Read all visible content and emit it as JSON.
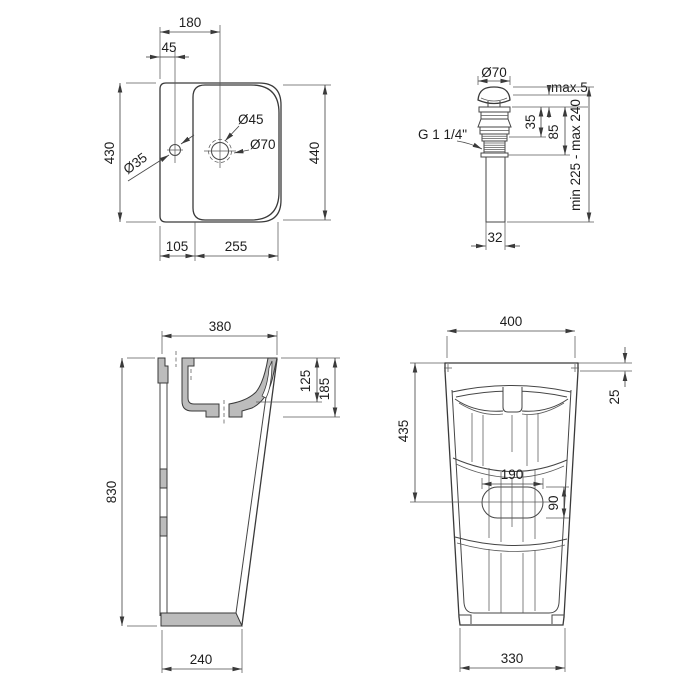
{
  "drawing": {
    "type": "technical-dimension-drawing",
    "subject": "freestanding washbasin with pop-up drain valve",
    "background_color": "#ffffff",
    "line_color": "#3a3a3a",
    "section_fill_color": "#bcbcbc",
    "views": {
      "top": {
        "name": "sink top view",
        "dims": {
          "drain_offset": "180",
          "faucet_offset": "45",
          "height_left": "430",
          "height_right": "440",
          "deck_width": "105",
          "bowl_width": "255",
          "drain_inner": "Ø45",
          "drain_outer": "Ø70",
          "faucet_hole": "Ø35"
        }
      },
      "valve": {
        "name": "pop-up drain valve",
        "dims": {
          "cap_diameter": "Ø70",
          "cap_gap": "max.5",
          "flange_depth": "35",
          "body_depth": "85",
          "thread": "G 1 1/4\"",
          "total_length": "min 225 - max 240",
          "pipe_diameter": "32"
        }
      },
      "side": {
        "name": "side section view",
        "dims": {
          "depth_top": "380",
          "bowl_inner_depth": "125",
          "bowl_outer_depth": "185",
          "total_height": "830",
          "base_depth": "240"
        }
      },
      "rear": {
        "name": "rear view",
        "dims": {
          "width_top": "400",
          "top_edge": "25",
          "height_to_opening": "435",
          "opening_width": "190",
          "opening_height": "90",
          "base_width": "330"
        }
      }
    }
  }
}
